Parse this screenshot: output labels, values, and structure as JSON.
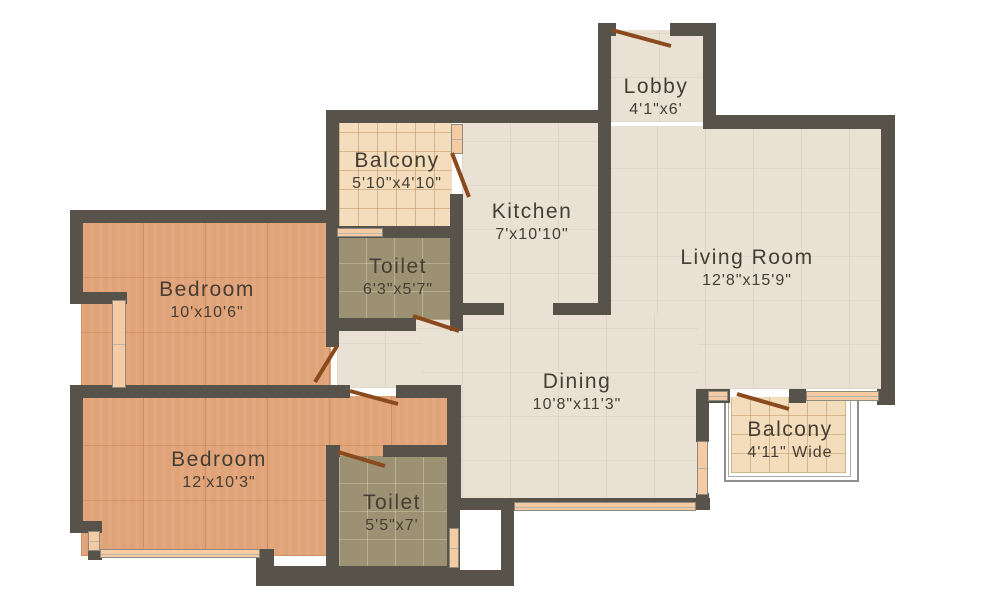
{
  "plan_title": "2BHK Apartment Floor Plan",
  "palette": {
    "wall": "#57524a",
    "floor_common": "#e9e2d4",
    "floor_bedroom": "#e0a277",
    "floor_balcony": "#f4ddbc",
    "floor_toilet": "#9c9273",
    "door": "#8a4a1e",
    "window": "#f5cba3",
    "label_text": "#453e35"
  },
  "rooms": [
    {
      "id": "lobby",
      "name": "Lobby",
      "dims": "4'1\"x6'"
    },
    {
      "id": "balcony-top",
      "name": "Balcony",
      "dims": "5'10\"x4'10\""
    },
    {
      "id": "kitchen",
      "name": "Kitchen",
      "dims": "7'x10'10\""
    },
    {
      "id": "living-room",
      "name": "Living Room",
      "dims": "12'8\"x15'9\""
    },
    {
      "id": "toilet-upper",
      "name": "Toilet",
      "dims": "6'3\"x5'7\""
    },
    {
      "id": "bedroom-upper",
      "name": "Bedroom",
      "dims": "10'x10'6\""
    },
    {
      "id": "dining",
      "name": "Dining",
      "dims": "10'8\"x11'3\""
    },
    {
      "id": "bedroom-lower",
      "name": "Bedroom",
      "dims": "12'x10'3\""
    },
    {
      "id": "toilet-lower",
      "name": "Toilet",
      "dims": "5'5\"x7'"
    },
    {
      "id": "balcony-right",
      "name": "Balcony",
      "dims": "4'11\" Wide"
    }
  ]
}
